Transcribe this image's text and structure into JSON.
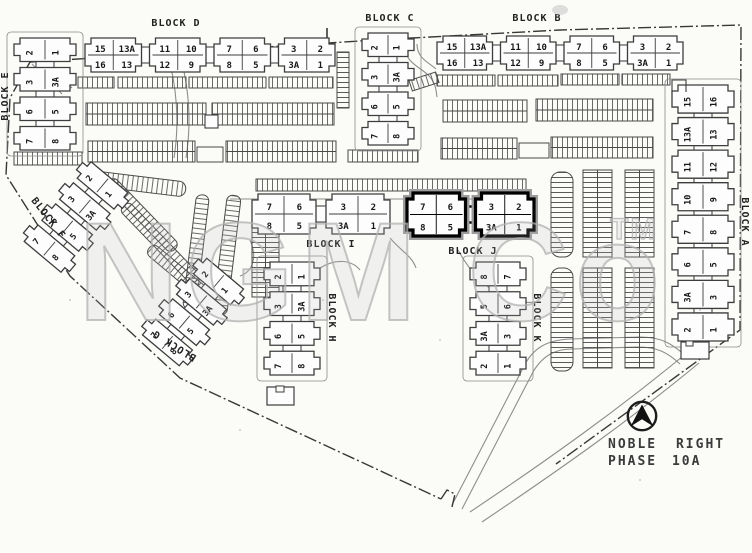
{
  "watermark": {
    "text": "NGM Co",
    "tm": "TM"
  },
  "legend": {
    "title_line1": "NOBLE RIGHT",
    "title_line2": "PHASE 10A"
  },
  "blocks": [
    {
      "id": "D",
      "label": "BLOCK D",
      "orient": "h",
      "sections": [
        [
          [
            "15",
            "16"
          ],
          [
            "13A",
            "13"
          ]
        ],
        [
          [
            "11",
            "12"
          ],
          [
            "10",
            "9"
          ]
        ],
        [
          [
            "7",
            "8"
          ],
          [
            "6",
            "5"
          ]
        ],
        [
          [
            "3",
            "3A"
          ],
          [
            "2",
            "1"
          ]
        ]
      ]
    },
    {
      "id": "B",
      "label": "BLOCK B",
      "orient": "h",
      "sections": [
        [
          [
            "15",
            "16"
          ],
          [
            "13A",
            "13"
          ]
        ],
        [
          [
            "11",
            "12"
          ],
          [
            "10",
            "9"
          ]
        ],
        [
          [
            "7",
            "8"
          ],
          [
            "6",
            "5"
          ]
        ],
        [
          [
            "3",
            "3A"
          ],
          [
            "2",
            "1"
          ]
        ]
      ]
    },
    {
      "id": "C",
      "label": "BLOCK C",
      "orient": "v",
      "sections": [
        [
          "2",
          "1"
        ],
        [
          "3",
          "3A"
        ],
        [
          "6",
          "5"
        ],
        [
          "7",
          "8"
        ]
      ]
    },
    {
      "id": "E",
      "label": "BLOCK E",
      "orient": "v",
      "sections": [
        [
          "2",
          "1"
        ],
        [
          "3",
          "3A"
        ],
        [
          "6",
          "5"
        ],
        [
          "7",
          "8"
        ]
      ]
    },
    {
      "id": "F",
      "label": "BLOCK F",
      "orient": "v",
      "sections": [
        [
          "2",
          "1"
        ],
        [
          "3",
          "3A"
        ],
        [
          "6",
          "5"
        ],
        [
          "7",
          "8"
        ]
      ]
    },
    {
      "id": "G",
      "label": "BLOCK G",
      "orient": "v",
      "sections": [
        [
          "2",
          "1"
        ],
        [
          "3",
          "3A"
        ],
        [
          "6",
          "5"
        ],
        [
          "7",
          "8"
        ]
      ]
    },
    {
      "id": "H",
      "label": "BLOCK H",
      "orient": "v",
      "sections": [
        [
          "2",
          "1"
        ],
        [
          "3",
          "3A"
        ],
        [
          "6",
          "5"
        ],
        [
          "7",
          "8"
        ]
      ]
    },
    {
      "id": "I",
      "label": "BLOCK I",
      "orient": "h",
      "sections": [
        [
          [
            "7",
            "8"
          ],
          [
            "6",
            "5"
          ]
        ],
        [
          [
            "3",
            "3A"
          ],
          [
            "2",
            "1"
          ]
        ]
      ]
    },
    {
      "id": "J",
      "label": "BLOCK J",
      "orient": "h",
      "highlight": true,
      "sections": [
        [
          [
            "7",
            "8"
          ],
          [
            "6",
            "5"
          ]
        ],
        [
          [
            "3",
            "3A"
          ],
          [
            "2",
            "1"
          ]
        ]
      ]
    },
    {
      "id": "K",
      "label": "BLOCK K",
      "orient": "v",
      "sections": [
        [
          "8",
          "7"
        ],
        [
          "5",
          "6"
        ],
        [
          "3A",
          "3"
        ],
        [
          "2",
          "1"
        ]
      ]
    },
    {
      "id": "A",
      "label": "BLOCK A",
      "orient": "v",
      "sections": [
        [
          "15",
          "16"
        ],
        [
          "13A",
          "13"
        ],
        [
          "11",
          "12"
        ],
        [
          "10",
          "9"
        ],
        [
          "7",
          "8"
        ],
        [
          "6",
          "5"
        ],
        [
          "3A",
          "3"
        ],
        [
          "2",
          "1"
        ]
      ]
    }
  ]
}
